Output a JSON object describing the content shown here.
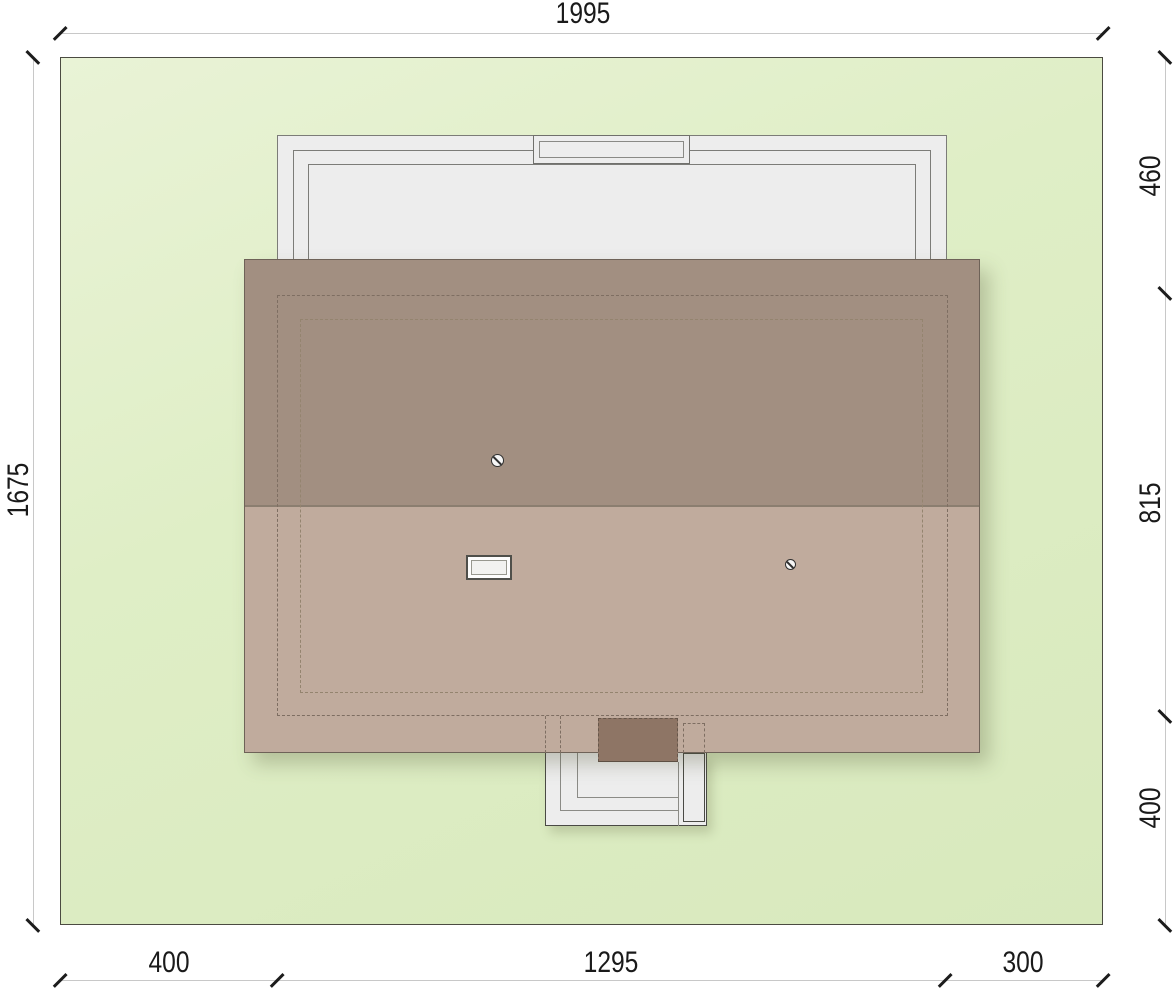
{
  "drawing": {
    "kind": "architectural-site-plan",
    "dim_top": {
      "label": "1995"
    },
    "dim_left": {
      "label": "1675"
    },
    "dim_right": {
      "segments": [
        "460",
        "815",
        "400"
      ]
    },
    "dim_bottom": {
      "segments": [
        "400",
        "1295",
        "300"
      ]
    },
    "icons": {
      "vent_1": "roof-vent",
      "vent_2": "roof-vent",
      "skylight": "skylight-window"
    },
    "colors": {
      "lawn": "#dfeec6",
      "roof_upper": "#a28f81",
      "roof_lower": "#c0ab9d",
      "structure_fill": "#ededed",
      "entry_recess": "#8e7565",
      "dim_text": "#1a1a1a"
    }
  }
}
